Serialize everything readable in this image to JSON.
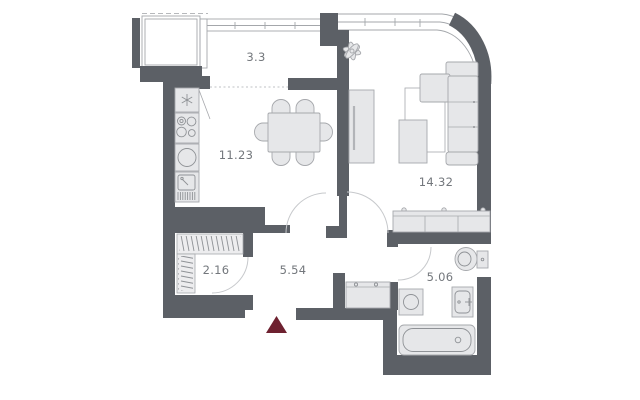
{
  "plan": {
    "title": "apartment-floor-plan",
    "rooms": [
      {
        "id": "balcony",
        "area": "3.3"
      },
      {
        "id": "kitchen-dining",
        "area": "11.23"
      },
      {
        "id": "living-room",
        "area": "14.32"
      },
      {
        "id": "wardrobe",
        "area": "2.16"
      },
      {
        "id": "hallway",
        "area": "5.54"
      },
      {
        "id": "bathroom",
        "area": "5.06"
      }
    ],
    "fixtures": [
      "fridge-icon",
      "cooktop-icon",
      "oven-icon",
      "kitchen-sink-icon",
      "dining-table-icon",
      "chair-icon",
      "tv-cabinet-icon",
      "rug-icon",
      "sofa-icon",
      "coffee-table-icon",
      "plant-icon",
      "sideboard-icon",
      "wardrobe-rail-icon",
      "washing-machine-icon",
      "bathroom-sink-icon",
      "toilet-icon",
      "bathtub-icon",
      "entrance-arrow-icon"
    ],
    "colors": {
      "wall": "#5c6066",
      "furn-fill": "#e6e7e9",
      "furn-stroke": "#a6a8ac",
      "label": "#73777c",
      "door-arc": "#c7c9cc",
      "window": "#a4a7ab",
      "hatch": "#c3c5c8",
      "marker": "#6e2130"
    }
  }
}
